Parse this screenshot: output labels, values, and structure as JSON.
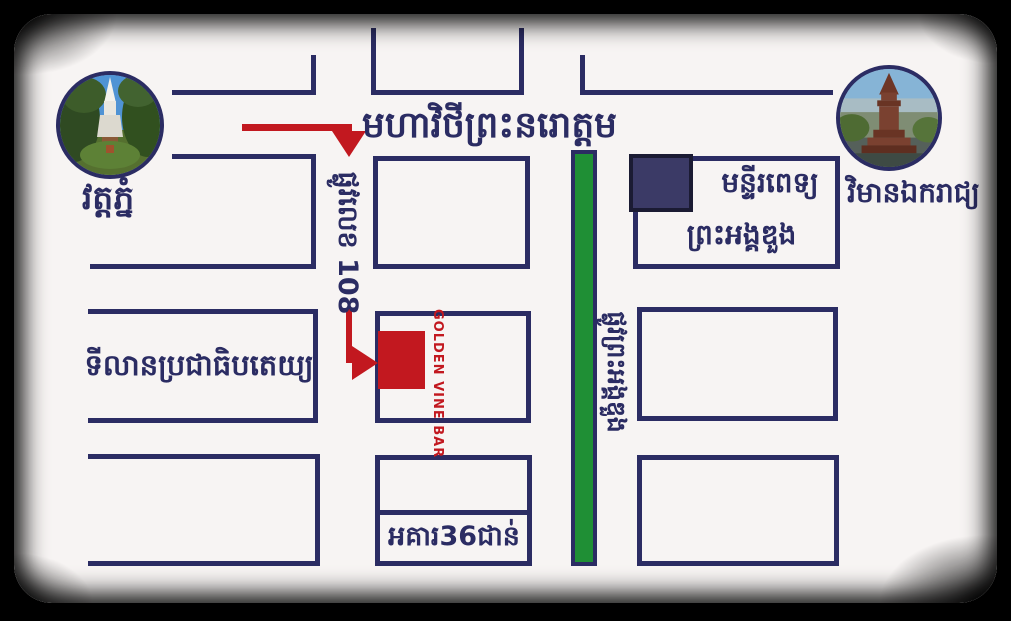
{
  "map_title": "Golden Vine Bar location map",
  "landmarks": {
    "wat_phnom": {
      "label": "វត្តភ្នំ",
      "icon": "wat-phnom-photo"
    },
    "independence_monument": {
      "label": "វិមានឯករាជ្យ",
      "icon": "independence-monument-photo"
    }
  },
  "streets": {
    "norodom_blvd": "មហាវិថីព្រះនរោត្តម",
    "street_108": "ផ្លូវលេខ 108",
    "preah_ang_duong_street": "ផ្លូវព្រះអង្គឌួង"
  },
  "buildings": {
    "hospital_line1": "មន្ទីរពេទ្យ",
    "hospital_line2": "ព្រះអង្គឌួង",
    "democracy_square": "ទីលានប្រជាធិបតេយ្យ",
    "building_36_floors": "អគារ36ជាន់",
    "golden_vine_bar": "GOLDEN VINE BAR"
  },
  "colors": {
    "line": "#2b2c63",
    "red": "#c2181f",
    "green": "#1f8f35",
    "navy": "#3b3a66",
    "navy_dark": "#1b1b33",
    "bg": "#f7f4f3",
    "frame": "#000000"
  }
}
